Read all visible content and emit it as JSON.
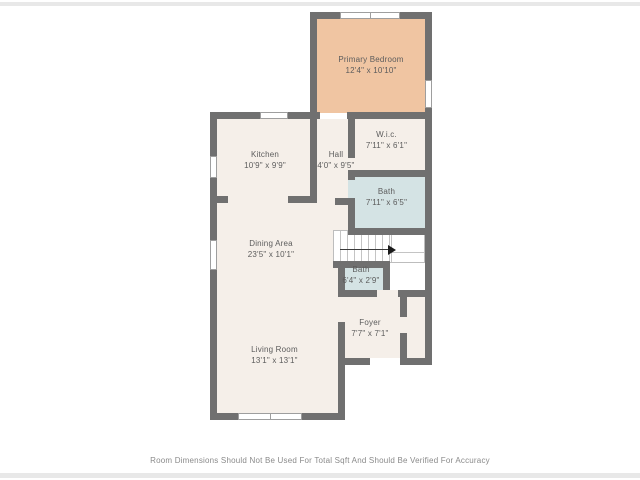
{
  "page": {
    "type": "floor-plan",
    "disclaimer": "Room Dimensions Should Not Be Used For Total Sqft And Should Be Verified For Accuracy"
  },
  "colors": {
    "wall": "#707070",
    "floor": "#f5efe9",
    "bedroom_fill": "#f0c5a2",
    "bath_fill": "#d4e3e4",
    "label_text": "#5c5c5c",
    "page_bar": "#e8e8e8"
  },
  "rooms": {
    "primary_bedroom": {
      "name": "Primary Bedroom",
      "dims": "12'4\" x 10'10\""
    },
    "wic": {
      "name": "W.i.c.",
      "dims": "7'11\" x 6'1\""
    },
    "bath_upper": {
      "name": "Bath",
      "dims": "7'11\" x 6'5\""
    },
    "kitchen": {
      "name": "Kitchen",
      "dims": "10'9\" x 9'9\""
    },
    "hall": {
      "name": "Hall",
      "dims": "4'0\" x 9'5\""
    },
    "dining_area": {
      "name": "Dining Area",
      "dims": "23'5\" x 10'1\""
    },
    "bath_lower": {
      "name": "Bath",
      "dims": "6'4\" x 2'9\""
    },
    "foyer": {
      "name": "Foyer",
      "dims": "7'7\" x 7'1\""
    },
    "living_room": {
      "name": "Living Room",
      "dims": "13'1\" x 13'1\""
    }
  }
}
